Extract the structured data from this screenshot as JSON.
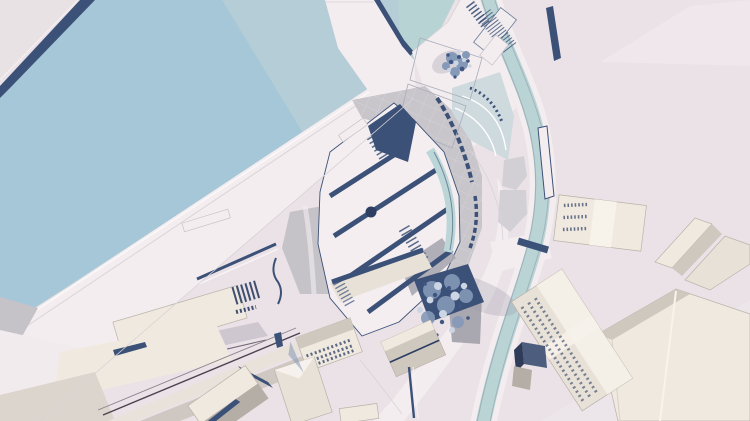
{
  "canvas": {
    "width": 750,
    "height": 421
  },
  "view": {
    "type": "3d-model-top-view",
    "subject": "urban-waterfront-site-model"
  },
  "colors": {
    "background": "#eae2e6",
    "background_light": "#f1eaee",
    "land_corner": "#e8e2e4",
    "water": "#a6c7d7",
    "water_light": "#b4cdd6",
    "water_teal": "#b7d3d4",
    "canal": "#bad4d6",
    "canal_edge": "#9fb4ba",
    "road": "#f3edf0",
    "navy": "#3c5177",
    "navy_dark": "#2c3f63",
    "gray_plaza": "#c8c5cb",
    "gray_wedge": "#c5c2c8",
    "gray_mid": "#a9a7b0",
    "cream": "#f0e9e0",
    "cream_wall": "#e8e1d7",
    "cream_bright": "#f7f2ea",
    "taupe": "#cfc8be",
    "taupe_dark": "#b5aea6",
    "slab_gray": "#dcd5cd",
    "slab_gray2": "#cfc8c2",
    "glass": "#bcd6d8",
    "steps": "#cfdade",
    "tree_dark": "#3f5680",
    "tree_mid": "#8599b8",
    "tree_light": "#ccd5e3",
    "slate_top": "#4d5d7d",
    "slate_side": "#2e3c59",
    "shadow": "#9b95a6",
    "white_roof": "#f4eef1"
  },
  "elements": [
    "water-basin",
    "quay-edge",
    "pier",
    "quay-promenade",
    "canal",
    "lattice-footbridge",
    "south-footbridge",
    "amphitheater-steps",
    "plaza-tree",
    "tree-courtyard",
    "central-glass-building",
    "gray-plaza",
    "quay-warehouse",
    "southwest-blocks",
    "gabled-buildings",
    "east-block-small",
    "east-zigzag-building",
    "east-big-slab",
    "east-windowed-building",
    "slate-cube",
    "jetty-bars",
    "moored-boat"
  ]
}
